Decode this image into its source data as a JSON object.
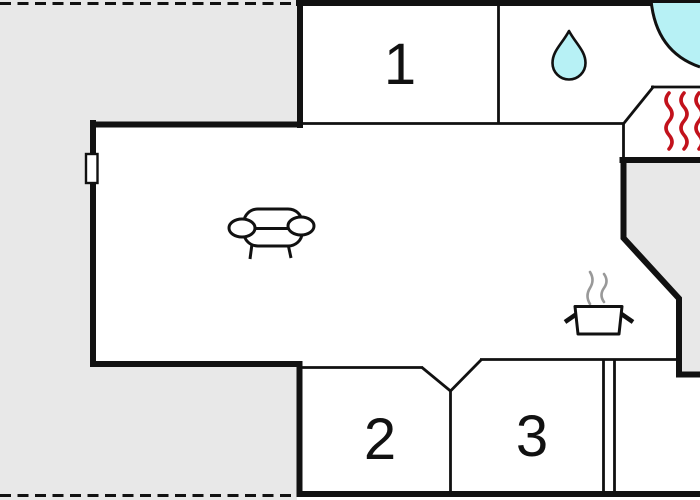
{
  "plan": {
    "type": "floor-plan",
    "rooms": [
      {
        "id": "room-1",
        "label": "1"
      },
      {
        "id": "room-2",
        "label": "2"
      },
      {
        "id": "room-3",
        "label": "3"
      }
    ],
    "icons": [
      {
        "name": "sofa-icon"
      },
      {
        "name": "water-drop-icon"
      },
      {
        "name": "corner-bathtub-icon"
      },
      {
        "name": "sauna-heat-icon"
      },
      {
        "name": "cooking-pot-icon"
      },
      {
        "name": "steam-icon"
      },
      {
        "name": "window-icon"
      }
    ],
    "colors": {
      "surround_gray": "#e8e8e8",
      "wall_black": "#111111",
      "water_cyan": "#b7f1f5",
      "heat_red": "#c2121c",
      "steam_gray": "#999999",
      "paper_white": "#ffffff"
    }
  }
}
